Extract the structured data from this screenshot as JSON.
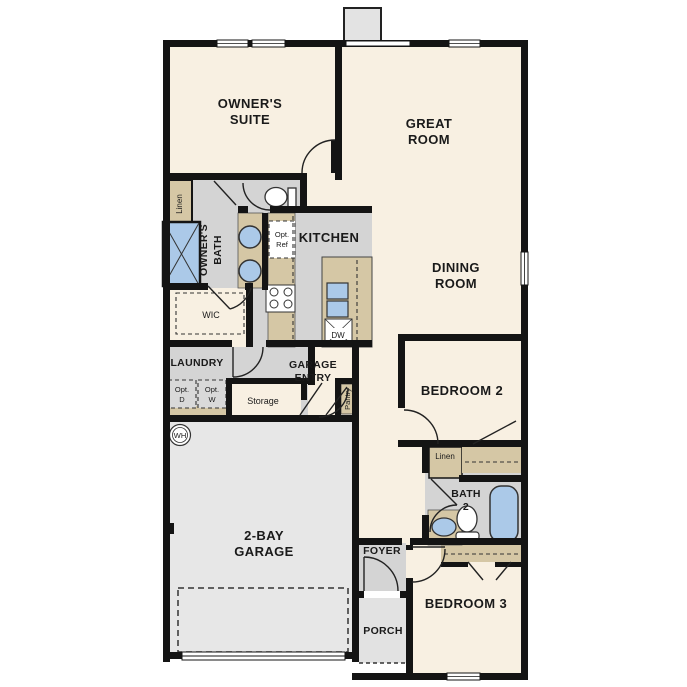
{
  "plan": {
    "rooms": {
      "owners_suite": {
        "line1": "OWNER'S",
        "line2": "SUITE"
      },
      "great_room": {
        "line1": "GREAT",
        "line2": "ROOM"
      },
      "dining_room": {
        "line1": "DINING",
        "line2": "ROOM"
      },
      "kitchen": {
        "label": "KITCHEN"
      },
      "owners_bath": {
        "line1": "OWNER'S",
        "line2": "BATH"
      },
      "wic": {
        "label": "WIC"
      },
      "laundry": {
        "label": "LAUNDRY"
      },
      "garage_entry": {
        "line1": "GARAGE",
        "line2": "ENTRY"
      },
      "garage": {
        "line1": "2-BAY",
        "line2": "GARAGE"
      },
      "bedroom2": {
        "label": "BEDROOM 2"
      },
      "bedroom3": {
        "label": "BEDROOM 3"
      },
      "bath2": {
        "line1": "BATH",
        "line2": "2"
      },
      "foyer": {
        "label": "FOYER"
      },
      "porch": {
        "label": "PORCH"
      }
    },
    "closets": {
      "linen_owners": "Linen",
      "linen_hall": "Linen",
      "pantry": "Pantry",
      "storage": "Storage"
    },
    "appliances": {
      "opt_ref": {
        "line1": "Opt.",
        "line2": "Ref"
      },
      "opt_d": {
        "line1": "Opt.",
        "line2": "D"
      },
      "opt_w": {
        "line1": "Opt.",
        "line2": "W"
      },
      "dishwasher": "DW",
      "water_heater": "WH"
    },
    "colors": {
      "floor_cream": "#f8f0e2",
      "floor_gray": "#d4d4d4",
      "floor_garage": "#e7e7e7",
      "floor_porch": "#e2e2e2",
      "counter_tan": "#d5c7a5",
      "fixture_blue": "#abc9e8",
      "wall": "#141414"
    }
  }
}
